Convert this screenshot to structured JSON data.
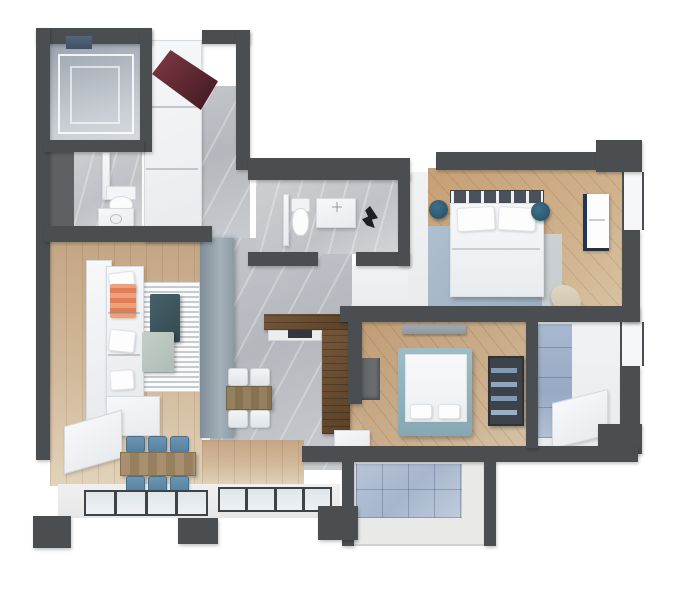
{
  "scene": {
    "type": "apartment-floor-plan-3d-render",
    "background": "#ffffff",
    "wall_color": "#4b4e50",
    "view": "top-down"
  },
  "palette": {
    "wall": "#4b4e50",
    "wood_floor": "#cdb092",
    "marble_floor": "#bfc2c6",
    "white_floor": "#eef0f1",
    "blue_tile": "#a7b6cd",
    "accent_teal_panel": "#8b9aa4",
    "entry_door_red": "#5c2730",
    "chair_blue": "#5e8cab",
    "nightstand_teal": "#2c5a70",
    "bed2_frame_teal": "#8fb2bc",
    "sofa_white": "#f1f2f4",
    "throw_coral": "#e8916c",
    "kitchen_walnut": "#6a5037"
  },
  "rooms": {
    "storage": {
      "name": "Walk-in storage / laundry with wire shelving",
      "floor": "#aeb6bf"
    },
    "guest_bathroom": {
      "name": "Guest bathroom (toilet, vanity sink)",
      "floor": "#ced2d5"
    },
    "entry_hall": {
      "name": "Entry hall with open dark-red door and white wardrobe",
      "floor": "#babec3"
    },
    "main_bathroom": {
      "name": "Main bathroom (toilet, vanity, dark plant)",
      "floor": "#c6c9cc"
    },
    "living_room": {
      "name": "Living room (white sofa, striped rug, coffee tables)",
      "floor": "#cfb697"
    },
    "dining_area": {
      "name": "Dining area (wood table, six blue chairs)",
      "floor": "#d2ba9c"
    },
    "kitchen_hall": {
      "name": "Kitchen / hallway (walnut L-counter, breakfast table)",
      "floor": "#bcc0c5"
    },
    "master_bedroom": {
      "name": "Master bedroom (double bed, blue rug, nightstands, pouf, window)",
      "floor": "#c9a87f",
      "rug": "#a3b6c6"
    },
    "second_bedroom": {
      "name": "Second bedroom (teal-frame bed, dresser, shelf unit)",
      "floor": "#c6a987"
    },
    "ensuite_bathroom": {
      "name": "En-suite shower room with blue tiles",
      "floor": "#eef0f1",
      "tile": "#a0b2ca"
    },
    "balcony": {
      "name": "Balcony with blue tiled floor",
      "tile": "#b0bed4"
    }
  },
  "furniture": [
    "white-wardrobe-column",
    "open-red-entry-door",
    "toilet",
    "vanity-sink",
    "white-sofa-l-shape",
    "coral-throw",
    "striped-rug",
    "dark-teal-coffee-table",
    "sage-coffee-table",
    "tv-console",
    "dining-table",
    "blue-dining-chairs",
    "breakfast-table",
    "white-chairs",
    "walnut-kitchen-counter",
    "cooktop",
    "double-bed",
    "round-nightstands",
    "beige-pouf",
    "teal-frame-bed",
    "dresser",
    "shelf-unit",
    "desk-niche",
    "shower-bench",
    "floor-windows"
  ]
}
